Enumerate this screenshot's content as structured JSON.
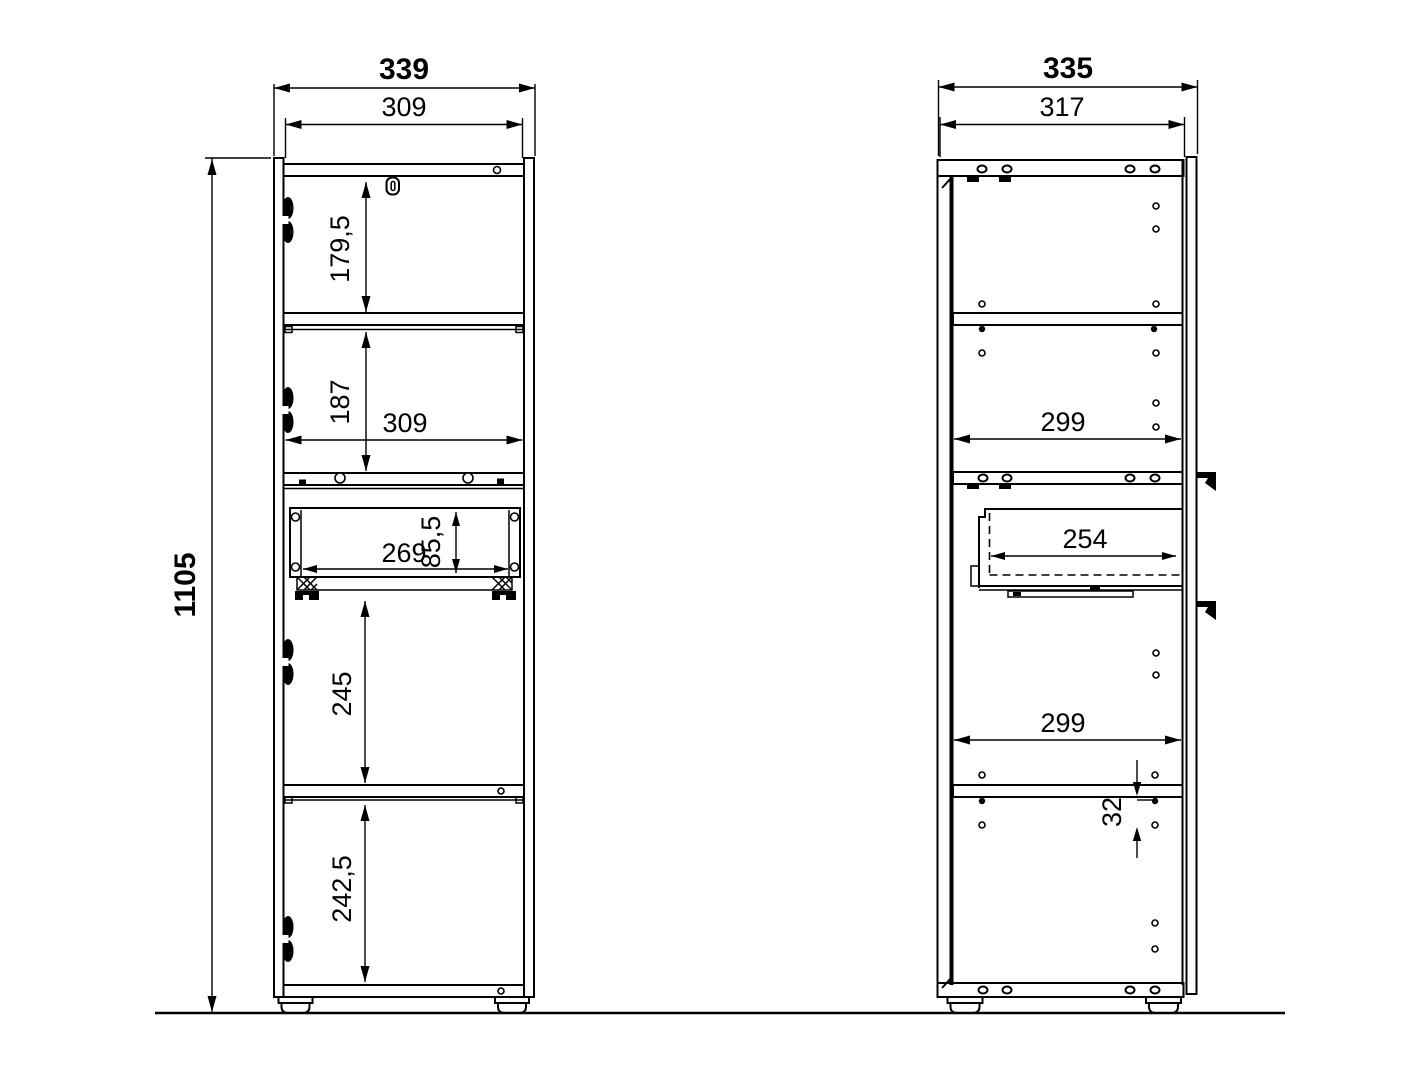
{
  "drawing": {
    "colors": {
      "line": "#000000",
      "background": "#ffffff"
    },
    "dimensions": {
      "front_view": {
        "overall_width": "339",
        "inner_width_top": "309",
        "overall_height": "1105",
        "section_1_height": "179,5",
        "section_2_height": "187",
        "inner_width_middle": "309",
        "drawer_inner_width": "269",
        "drawer_inner_height": "85,5",
        "section_3_height": "245",
        "section_4_height": "242,5"
      },
      "side_view": {
        "overall_depth": "335",
        "inner_depth_top": "317",
        "inner_depth_upper": "299",
        "drawer_inner_depth": "254",
        "inner_depth_lower": "299",
        "hole_pitch": "32"
      }
    }
  }
}
